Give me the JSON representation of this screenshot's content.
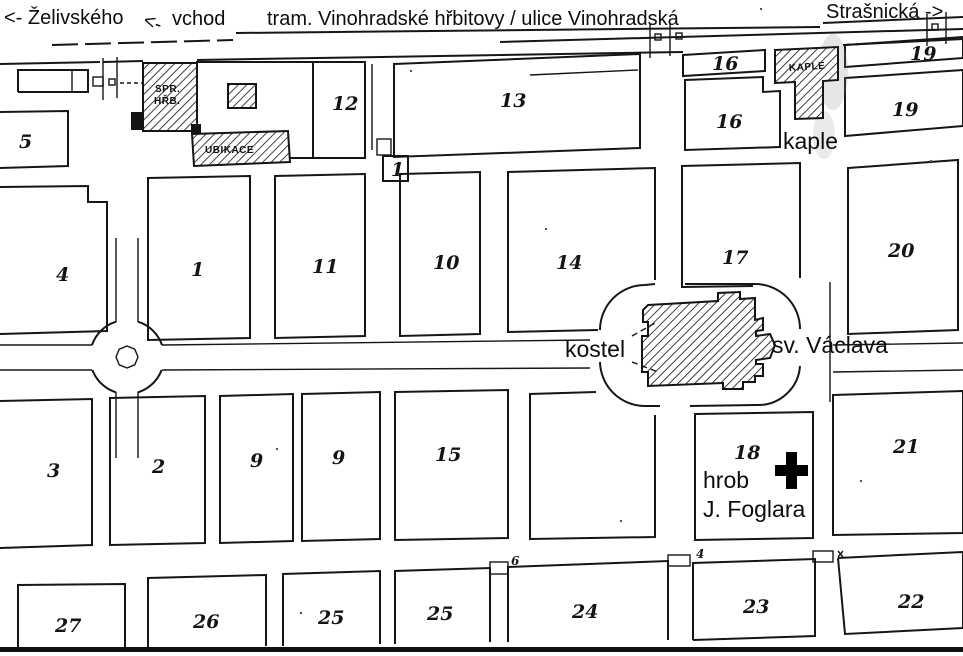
{
  "header": {
    "left_street": "<- Želivského",
    "entrance_label": "vchod",
    "tram_label": "tram. Vinohradské hřbitovy / ulice Vinohradská",
    "right_street": "Strašnická ->"
  },
  "landmarks": {
    "admin_line1": "SPR.",
    "admin_line2": "HŘB.",
    "ubikace": "UBIKACE",
    "chapel_building": "KAPLE",
    "chapel": "kaple",
    "church_prefix": "kostel",
    "church_name": "sv. Václava",
    "grave_line1": "hrob",
    "grave_line2": "J. Foglara"
  },
  "icons": {
    "entrance_arrow": "<-",
    "grave_cross": "+"
  },
  "plot_labels": {
    "p5": "5",
    "p12": "12",
    "p13": "13",
    "p16_strip": "16",
    "p16": "16",
    "p19_strip": "19",
    "p19": "19",
    "p4": "4",
    "p1": "1",
    "p11": "11",
    "p10": "10",
    "p14": "14",
    "p17": "17",
    "p20": "20",
    "p3": "3",
    "p2": "2",
    "p9_west": "9",
    "p9_east": "9",
    "p15": "15",
    "p18": "18",
    "p21": "21",
    "p27": "27",
    "p26": "26",
    "p25_west": "25",
    "p25_east": "25",
    "p24": "24",
    "p23": "23",
    "p22": "22"
  },
  "gate_labels": {
    "gate1": "1",
    "gate6": "6",
    "gate4": "4"
  },
  "map_colors": {
    "ink": "#161616",
    "paper": "#ffffff"
  }
}
